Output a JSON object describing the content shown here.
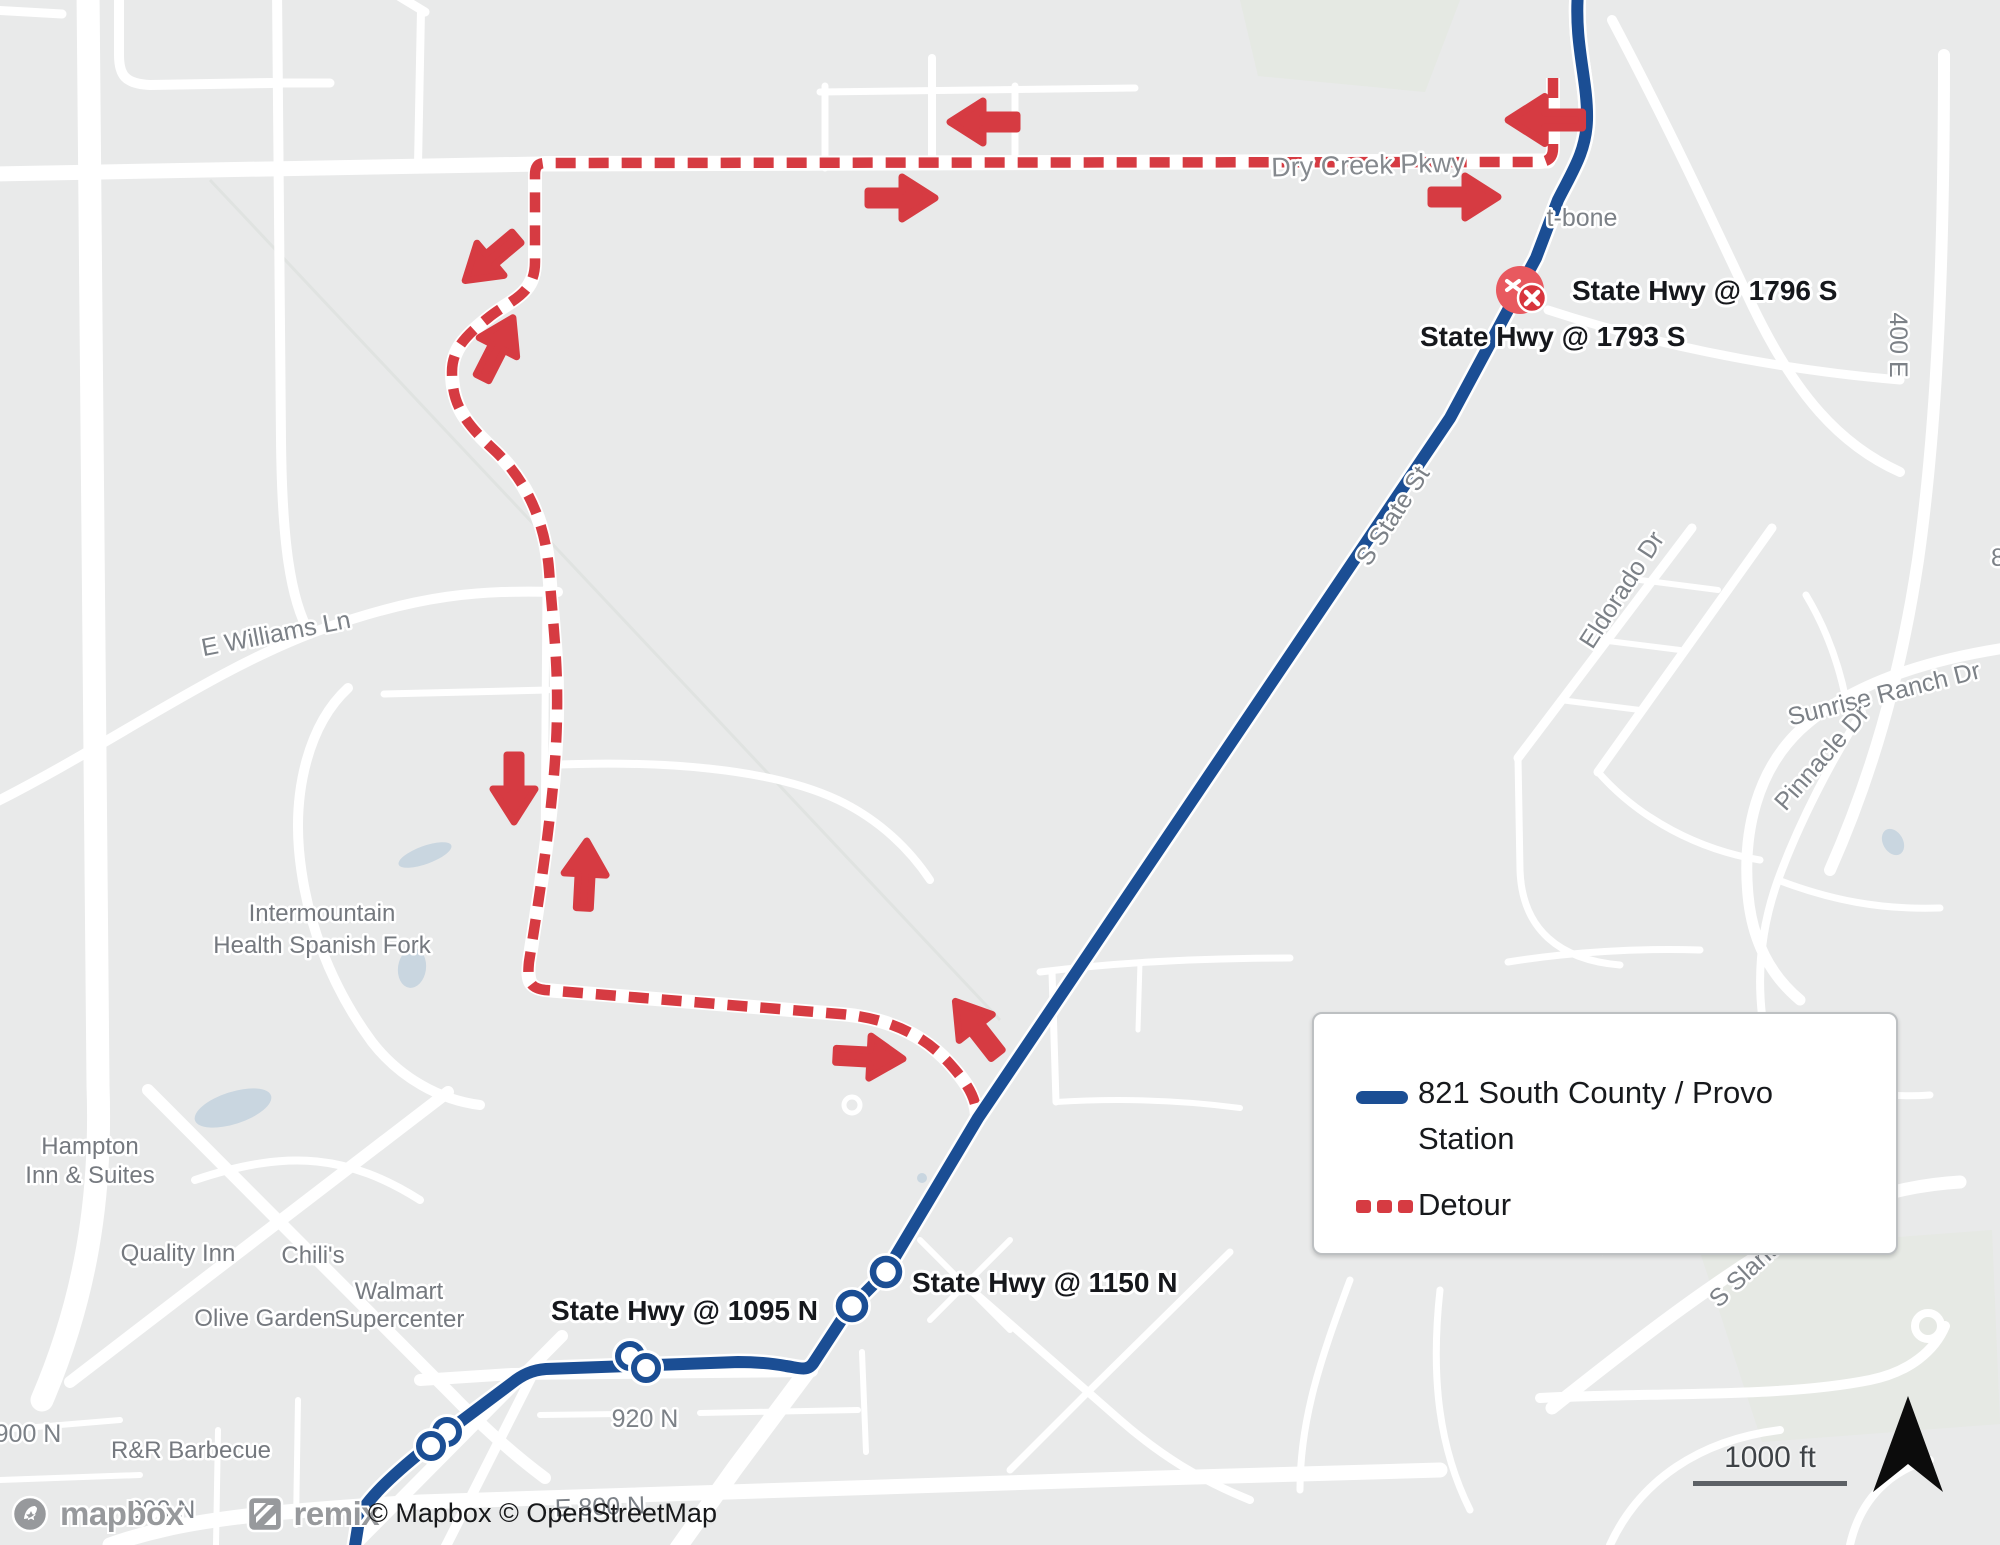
{
  "map": {
    "attribution": "© Mapbox © OpenStreetMap",
    "scale": {
      "label": "1000 ft"
    },
    "logos": {
      "mapbox": "mapbox",
      "remix": "remix"
    },
    "colors": {
      "route": "#1b4e94",
      "detour": "#d63b42",
      "background": "#e9eaea",
      "road": "#ffffff"
    }
  },
  "legend": {
    "route": {
      "line1": "821 South County / Provo",
      "line2": "Station"
    },
    "detour": {
      "label": "Detour"
    }
  },
  "stops": {
    "hwy1796": "State Hwy @ 1796 S",
    "hwy1793": "State Hwy @ 1793 S",
    "hwy1150": "State Hwy @ 1150 N",
    "hwy1095": "State Hwy @ 1095 N"
  },
  "streets": {
    "dry_creek": "Dry Creek Pkwy",
    "t_bone": "t-bone",
    "e400": "400 E",
    "s_state": "S State St",
    "eldorado": "Eldorado Dr",
    "sunrise": "Sunrise Ranch Dr",
    "pinnacle": "Pinnacle Dr",
    "williams": "E Williams Ln",
    "n920": "920 N",
    "n900": "900 N",
    "n800": "800 N",
    "e800": "E 800 N",
    "slant": "S Slant Ro",
    "partial_t": "t",
    "partial_8": "8"
  },
  "places": {
    "intermountain_l1": "Intermountain",
    "intermountain_l2": "Health Spanish Fork",
    "hampton_l1": "Hampton",
    "hampton_l2": "Inn & Suites",
    "quality": "Quality Inn",
    "chilis": "Chili's",
    "walmart_l1": "Walmart",
    "walmart_l2": "Supercenter",
    "olive": "Olive Garden",
    "rr": "R&R Barbecue"
  }
}
